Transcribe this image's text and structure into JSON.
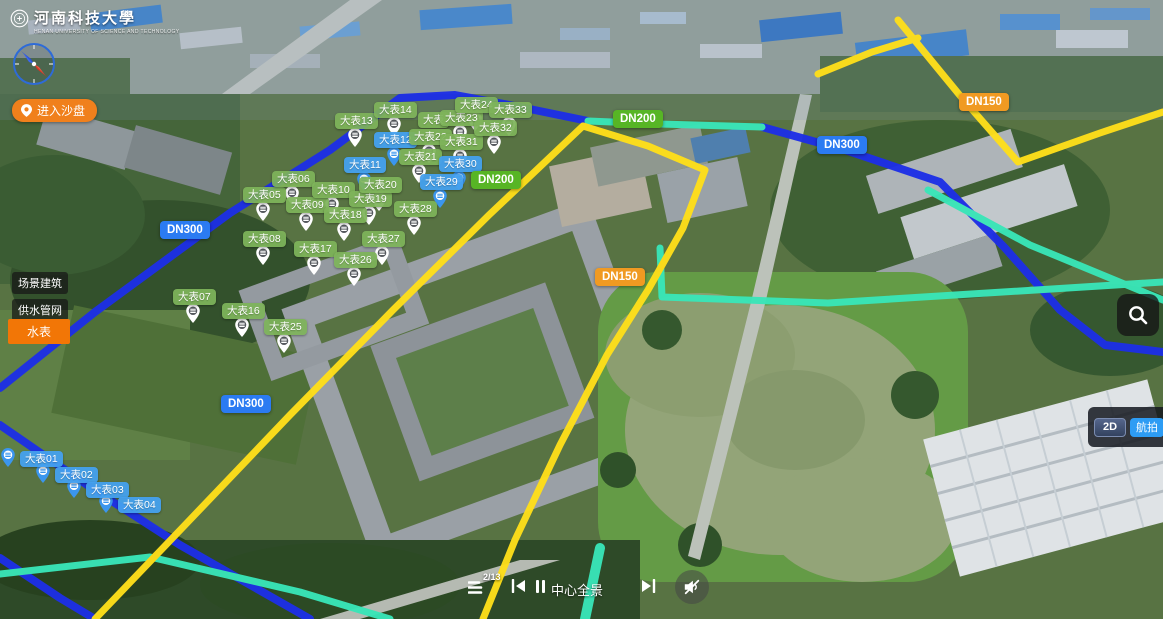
{
  "logo": {
    "title": "河南科技大學",
    "subtitle": "HENAN UNIVERSITY OF SCIENCE AND TECHNOLOGY"
  },
  "buttons": {
    "enter_sandbox": "进入沙盘",
    "mode_2d": "2D",
    "mode_aerial": "航拍"
  },
  "layers": {
    "items": [
      {
        "label": "场景建筑",
        "active": false
      },
      {
        "label": "供水管网",
        "active": false
      },
      {
        "label": "水表",
        "active": true
      }
    ]
  },
  "player": {
    "counter": "2/13",
    "title": "中心全景",
    "muted": true
  },
  "icons": [
    "university-seal",
    "compass",
    "location-pin",
    "search-magnifier",
    "playlist",
    "previous-track",
    "pause",
    "next-track",
    "speaker-muted",
    "water-meter-pin"
  ],
  "colors": {
    "marker_green": "#7eb45a",
    "marker_blue": "#44a0ee",
    "dn_blue": "#2b7bf2",
    "dn_green": "#57b525",
    "dn_orange": "#f09a22",
    "accent_orange": "#f27606",
    "aerial_blue": "#2d9cf4",
    "pipe_blue": "#1d2fe6",
    "pipe_yellow": "#ffdf1a",
    "pipe_teal": "#39e6b8"
  },
  "map": {
    "meters": [
      {
        "label": "大表01",
        "color": "blue",
        "x": 20,
        "y": 451,
        "pin": "left"
      },
      {
        "label": "大表02",
        "color": "blue",
        "x": 55,
        "y": 467,
        "pin": "left"
      },
      {
        "label": "大表03",
        "color": "blue",
        "x": 86,
        "y": 482,
        "pin": "left"
      },
      {
        "label": "大表04",
        "color": "blue",
        "x": 118,
        "y": 497,
        "pin": "left"
      },
      {
        "label": "大表05",
        "color": "green",
        "x": 243,
        "y": 187,
        "pin": "below"
      },
      {
        "label": "大表06",
        "color": "green",
        "x": 272,
        "y": 171,
        "pin": "below"
      },
      {
        "label": "大表07",
        "color": "green",
        "x": 173,
        "y": 289,
        "pin": "below"
      },
      {
        "label": "大表08",
        "color": "green",
        "x": 243,
        "y": 231,
        "pin": "below"
      },
      {
        "label": "大表09",
        "color": "green",
        "x": 286,
        "y": 197,
        "pin": "below"
      },
      {
        "label": "大表10",
        "color": "green",
        "x": 312,
        "y": 182,
        "pin": "below"
      },
      {
        "label": "大表11",
        "color": "blue",
        "x": 344,
        "y": 157,
        "pin": "below"
      },
      {
        "label": "大表12",
        "color": "blue",
        "x": 374,
        "y": 132,
        "pin": "below"
      },
      {
        "label": "大表13",
        "color": "green",
        "x": 335,
        "y": 113,
        "pin": "below"
      },
      {
        "label": "大表14",
        "color": "green",
        "x": 374,
        "y": 102,
        "pin": "below"
      },
      {
        "label": "大表16",
        "color": "green",
        "x": 222,
        "y": 303,
        "pin": "below"
      },
      {
        "label": "大表17",
        "color": "green",
        "x": 294,
        "y": 241,
        "pin": "below"
      },
      {
        "label": "大表18",
        "color": "green",
        "x": 324,
        "y": 207,
        "pin": "below"
      },
      {
        "label": "大表19",
        "color": "green",
        "x": 349,
        "y": 191,
        "pin": "below"
      },
      {
        "label": "大表20",
        "color": "green",
        "x": 359,
        "y": 177,
        "pin": "below"
      },
      {
        "label": "大表21",
        "color": "green",
        "x": 399,
        "y": 149,
        "pin": "below"
      },
      {
        "label": "大表22",
        "color": "green",
        "x": 409,
        "y": 129,
        "pin": "below"
      },
      {
        "label": "大表",
        "color": "green",
        "x": 418,
        "y": 112,
        "pin": null,
        "behind": true
      },
      {
        "label": "大表23",
        "color": "green",
        "x": 440,
        "y": 110,
        "pin": "below"
      },
      {
        "label": "大表24",
        "color": "green",
        "x": 455,
        "y": 97,
        "pin": "below"
      },
      {
        "label": "大表25",
        "color": "green",
        "x": 264,
        "y": 319,
        "pin": "below"
      },
      {
        "label": "大表26",
        "color": "green",
        "x": 334,
        "y": 252,
        "pin": "below"
      },
      {
        "label": "大表27",
        "color": "green",
        "x": 362,
        "y": 231,
        "pin": "below"
      },
      {
        "label": "大表28",
        "color": "green",
        "x": 394,
        "y": 201,
        "pin": "below"
      },
      {
        "label": "大表29",
        "color": "blue",
        "x": 420,
        "y": 174,
        "pin": "below"
      },
      {
        "label": "大表30",
        "color": "blue",
        "x": 439,
        "y": 156,
        "pin": "below"
      },
      {
        "label": "大表31",
        "color": "green",
        "x": 440,
        "y": 134,
        "pin": "below"
      },
      {
        "label": "大表32",
        "color": "green",
        "x": 474,
        "y": 120,
        "pin": "below"
      },
      {
        "label": "大表33",
        "color": "green",
        "x": 489,
        "y": 102,
        "pin": "below"
      }
    ],
    "pipe_labels": [
      {
        "label": "DN300",
        "color": "blue",
        "x": 160,
        "y": 221
      },
      {
        "label": "DN300",
        "color": "blue",
        "x": 221,
        "y": 395
      },
      {
        "label": "DN300",
        "color": "blue",
        "x": 817,
        "y": 136
      },
      {
        "label": "DN200",
        "color": "green",
        "x": 613,
        "y": 110
      },
      {
        "label": "DN200",
        "color": "green",
        "x": 471,
        "y": 171
      },
      {
        "label": "DN150",
        "color": "orange",
        "x": 595,
        "y": 268
      },
      {
        "label": "DN150",
        "color": "orange",
        "x": 959,
        "y": 93
      }
    ],
    "pipes": [
      {
        "color": "blue",
        "w": 8,
        "points": "0,425 90,487 180,545 310,619"
      },
      {
        "color": "blue",
        "w": 8,
        "points": "0,558 60,598 95,619"
      },
      {
        "color": "blue",
        "w": 8,
        "points": "0,388 95,312 230,213 330,150 400,98 455,95 520,107 588,121"
      },
      {
        "color": "blue",
        "w": 8,
        "points": "762,127 845,150 940,182 1005,248 1060,310 1105,345 1163,352"
      },
      {
        "color": "teal",
        "w": 7,
        "points": "588,121 660,124 762,127"
      },
      {
        "color": "teal",
        "w": 7,
        "points": "660,248 662,297 828,303 1163,282"
      },
      {
        "color": "teal",
        "w": 7,
        "points": "928,190 1030,245 1163,300"
      },
      {
        "color": "teal",
        "w": 7,
        "points": "0,574 150,557 300,592 390,619"
      },
      {
        "color": "teal",
        "w": 10,
        "points": "600,548 585,619"
      },
      {
        "color": "yellow",
        "w": 7,
        "points": "583,126 489,215 393,310 290,415 185,525 95,619"
      },
      {
        "color": "yellow",
        "w": 7,
        "points": "583,126 648,146 705,170 683,228 648,290 607,355 560,445 515,540 483,619"
      },
      {
        "color": "yellow",
        "w": 7,
        "points": "818,74 872,52 918,38"
      },
      {
        "color": "yellow",
        "w": 7,
        "points": "898,20 962,98 1018,162 1100,133 1163,112"
      }
    ]
  }
}
